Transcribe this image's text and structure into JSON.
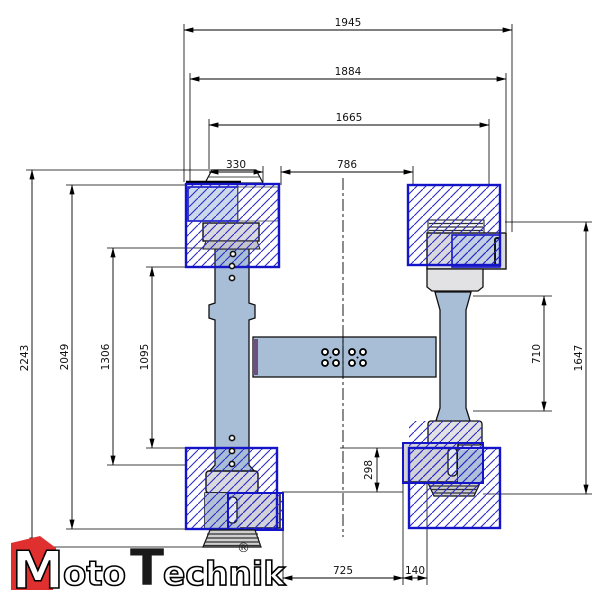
{
  "drawing": {
    "dims": {
      "top": [
        "1945",
        "1884",
        "1665",
        "330",
        "786"
      ],
      "left": [
        "2243",
        "2049",
        "1306",
        "1095"
      ],
      "right": [
        "710",
        "1647"
      ],
      "middle": [
        "298"
      ],
      "bottom": [
        "725",
        "140"
      ]
    }
  },
  "logo": {
    "word1_initial": "M",
    "word1_rest": "oto",
    "word2_initial": "T",
    "word2_rest": "echnik",
    "registered": "®"
  },
  "colors": {
    "hatch_blue": "#2a2ac8",
    "platform_border": "#1414c8",
    "steel_blue": "#a8bdd6",
    "clamp_grey": "#d9d9de",
    "crossbeam_end_purple": "#6b5080",
    "logo_red": "#e02f2f"
  }
}
